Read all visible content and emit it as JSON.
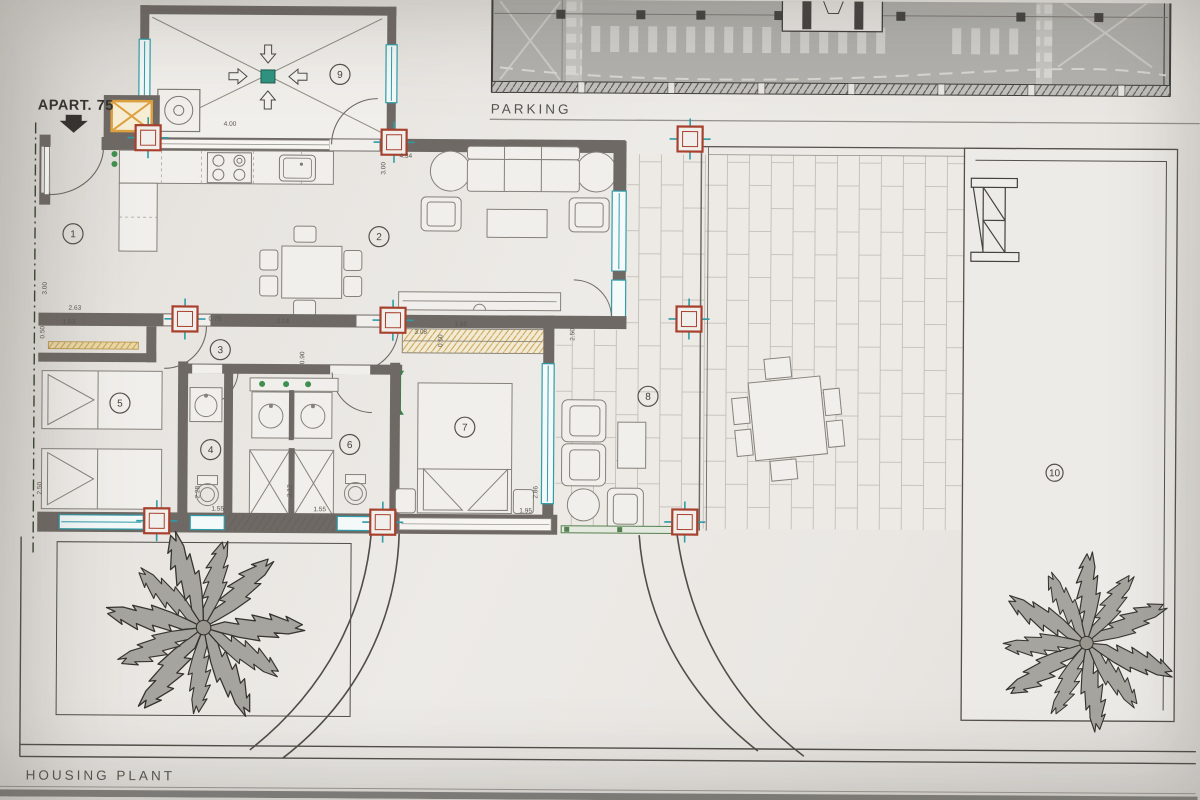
{
  "titles": {
    "parking": "PARKING",
    "plan": "HOUSING PLANT",
    "apartment": "APART. 75"
  },
  "colors": {
    "paper": "#ebe8e4",
    "wall": "#6f6965",
    "teal": "#2f9ca8",
    "column_red": "#a8402e",
    "shaft_yellow": "#dfa13f",
    "closet_yellow": "#c49a45",
    "drain_green": "#2f9480",
    "door_green": "#3f7d4a",
    "parking_fill": "#b2b1ad",
    "line": "#55504c"
  },
  "rooms": [
    {
      "num": "1",
      "x": 72,
      "y": 237,
      "r": 10
    },
    {
      "num": "2",
      "x": 378,
      "y": 238,
      "r": 10
    },
    {
      "num": "3",
      "x": 220,
      "y": 352,
      "r": 10
    },
    {
      "num": "4",
      "x": 211,
      "y": 452,
      "r": 10
    },
    {
      "num": "5",
      "x": 120,
      "y": 406,
      "r": 10
    },
    {
      "num": "6",
      "x": 350,
      "y": 446,
      "r": 10
    },
    {
      "num": "7",
      "x": 465,
      "y": 428,
      "r": 10
    },
    {
      "num": "8",
      "x": 648,
      "y": 396,
      "r": 10
    },
    {
      "num": "9",
      "x": 338,
      "y": 76,
      "r": 10
    },
    {
      "num": "10",
      "x": 1055,
      "y": 470,
      "r": 8.5
    }
  ],
  "dimensions": [
    {
      "label": "4.00",
      "x": 222,
      "y": 128,
      "vert": false
    },
    {
      "label": "4.34",
      "x": 398,
      "y": 159,
      "vert": false
    },
    {
      "label": "3.00",
      "x": 384,
      "y": 176,
      "vert": true
    },
    {
      "label": "3.00",
      "x": 46,
      "y": 298,
      "vert": true
    },
    {
      "label": "2.63",
      "x": 68,
      "y": 313,
      "vert": false
    },
    {
      "label": "1.53",
      "x": 62,
      "y": 327,
      "vert": false
    },
    {
      "label": "0.50",
      "x": 44,
      "y": 342,
      "vert": true
    },
    {
      "label": "0.75",
      "x": 208,
      "y": 323,
      "vert": false
    },
    {
      "label": "2.14",
      "x": 276,
      "y": 325,
      "vert": false
    },
    {
      "label": "0.90",
      "x": 304,
      "y": 366,
      "vert": true
    },
    {
      "label": "1.95",
      "x": 454,
      "y": 327,
      "vert": false
    },
    {
      "label": "3.08",
      "x": 414,
      "y": 335,
      "vert": false
    },
    {
      "label": "0.50",
      "x": 442,
      "y": 348,
      "vert": true
    },
    {
      "label": "2.50",
      "x": 574,
      "y": 341,
      "vert": true
    },
    {
      "label": "2.86",
      "x": 538,
      "y": 499,
      "vert": true
    },
    {
      "label": "1.95",
      "x": 520,
      "y": 513,
      "vert": false
    },
    {
      "label": "2.50",
      "x": 42,
      "y": 498,
      "vert": true
    },
    {
      "label": "2.28",
      "x": 200,
      "y": 501,
      "vert": true
    },
    {
      "label": "1.55",
      "x": 212,
      "y": 513,
      "vert": false
    },
    {
      "label": "2.12",
      "x": 292,
      "y": 499,
      "vert": true
    },
    {
      "label": "1.55",
      "x": 314,
      "y": 513,
      "vert": false
    }
  ],
  "columns": [
    {
      "x": 134,
      "y": 128
    },
    {
      "x": 380,
      "y": 131
    },
    {
      "x": 676,
      "y": 126
    },
    {
      "x": 172,
      "y": 309
    },
    {
      "x": 380,
      "y": 309
    },
    {
      "x": 676,
      "y": 306
    },
    {
      "x": 145,
      "y": 511
    },
    {
      "x": 371,
      "y": 511
    },
    {
      "x": 673,
      "y": 509
    }
  ]
}
